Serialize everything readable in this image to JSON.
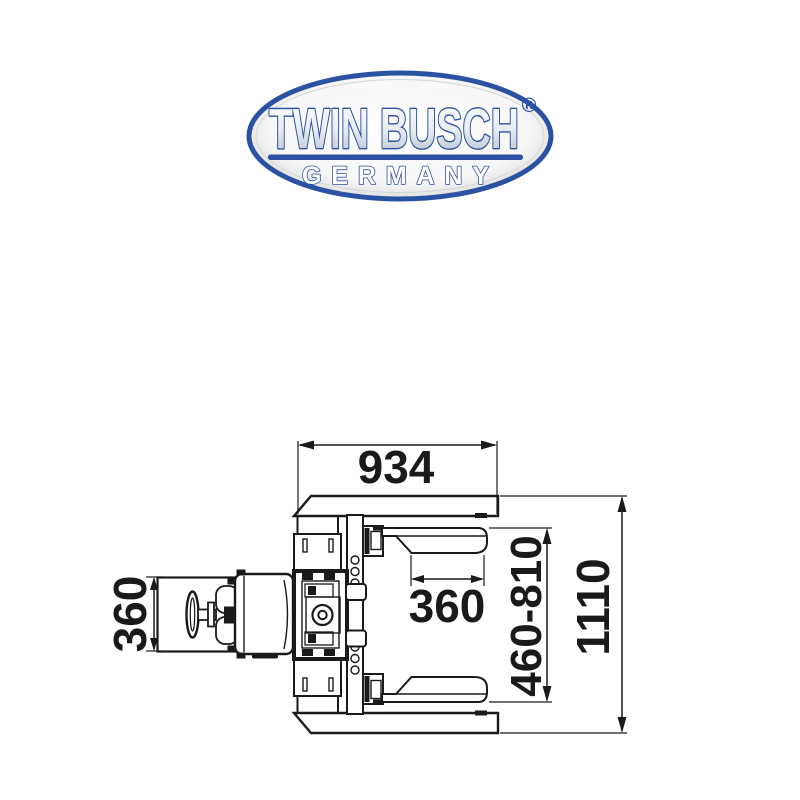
{
  "logo": {
    "brand": "TWIN BUSCH",
    "registered": "®",
    "country": "GERMANY",
    "blue": "#2b51a3"
  },
  "drawing": {
    "line_color": "#1a1a1a",
    "dimensions": {
      "top_width": "934",
      "pad_width": "360",
      "housing_width": "360",
      "arm_span": "460-810",
      "overall_depth": "1110"
    }
  }
}
